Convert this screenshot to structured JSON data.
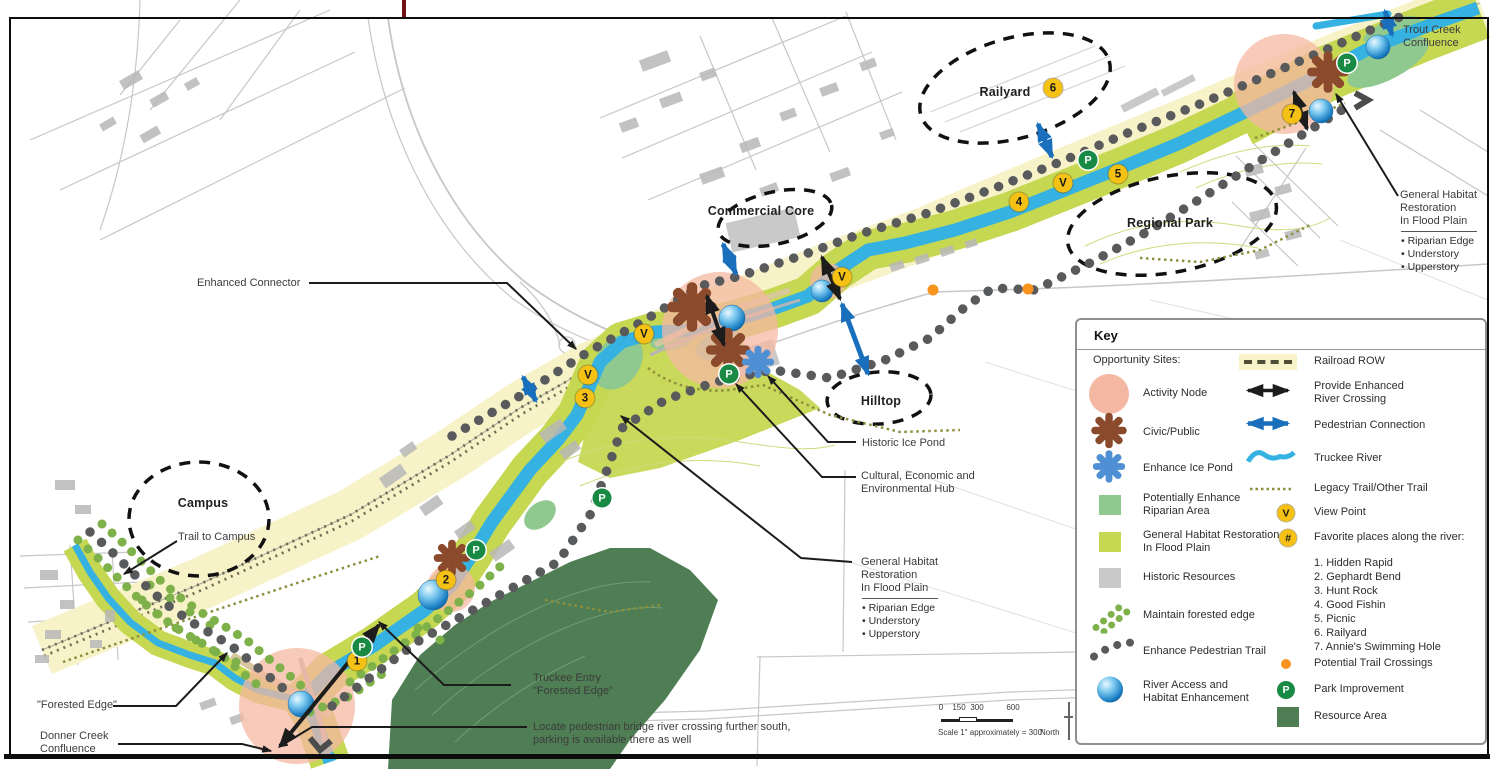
{
  "map": {
    "zone_labels": {
      "railyard": "Railyard",
      "commercial_core": "Commercial Core",
      "regional_park": "Regional Park",
      "hilltop": "Hilltop",
      "campus": "Campus"
    },
    "callouts": {
      "enhanced_connector": "Enhanced  Connector",
      "trail_to_campus": "Trail to Campus",
      "forested_edge": "\"Forested Edge\"",
      "donner_creek": "Donner Creek\nConfluence",
      "truckee_entry": "Truckee Entry\n\"Forested Edge\"",
      "pedestrian_bridge": "Locate pedestrian bridge river crossing further south,\nparking is available there as well",
      "historic_ice_pond": "Historic Ice Pond",
      "cultural_hub": "Cultural, Economic and\nEnvironmental Hub",
      "habitat_center": "General Habitat\nRestoration\nIn Flood Plain",
      "habitat_center_bullets": "• Riparian Edge\n• Understory\n• Upperstory",
      "trout_creek": "Trout Creek\nConfluence",
      "habitat_right": "General Habitat\nRestoration\nIn Flood Plain",
      "habitat_right_bullets": "• Riparian Edge\n• Understory\n• Upperstory"
    },
    "markers": {
      "viewpoint": "V",
      "park": "P",
      "numbers": [
        "1",
        "2",
        "3",
        "4",
        "5",
        "6",
        "7"
      ]
    }
  },
  "scalebar": {
    "ticks": [
      "0",
      "150",
      "300",
      "600"
    ],
    "caption": "Scale 1\" approximately = 300'",
    "north_label": "North"
  },
  "key": {
    "title": "Key",
    "opportunity_header": "Opportunity Sites:",
    "left_items": [
      {
        "label": "Activity Node"
      },
      {
        "label": "Civic/Public"
      },
      {
        "label": "Enhance Ice Pond"
      },
      {
        "label": "Potentially Enhance\nRiparian Area"
      },
      {
        "label": "General Habitat Restoration\nIn Flood Plain"
      },
      {
        "label": "Historic Resources"
      },
      {
        "label": "Maintain forested edge"
      },
      {
        "label": "Enhance Pedestrian Trail"
      },
      {
        "label": "River Access and\nHabitat Enhancement"
      }
    ],
    "right_items": [
      {
        "label": "Railroad ROW"
      },
      {
        "label": "Provide Enhanced\nRiver Crossing"
      },
      {
        "label": "Pedestrian Connection"
      },
      {
        "label": "Truckee River"
      },
      {
        "label": "Legacy Trail/Other Trail"
      },
      {
        "label": "View Point"
      },
      {
        "label": "Favorite places along the river:"
      },
      {
        "label": "Potential Trail Crossings"
      },
      {
        "label": "Park Improvement"
      },
      {
        "label": "Resource Area"
      }
    ],
    "favorites": [
      "1. Hidden Rapid",
      "2. Gephardt Bend",
      "3. Hunt Rock",
      "4. Good Fishin",
      "5. Picnic",
      "6. Railyard",
      "7. Annie's Swimming Hole"
    ],
    "viewpoint_glyph": "V",
    "favorites_glyph": "#",
    "park_glyph": "P"
  },
  "colors": {
    "row": "#f7f2c8",
    "habitat": "#c6d752",
    "riparian": "#8fc98f",
    "resource": "#4f7d54",
    "river": "#35b2e2",
    "activity": "#f4b8a2",
    "civic": "#8a4a2b",
    "icepond": "#4f8fd4",
    "viewpoint": "#f6c115",
    "park": "#188a44",
    "crossing": "#f8941e",
    "traildot": "#595a5c",
    "legacy": "#8e8f3d",
    "pedestrian": "#1a6fbd",
    "historic": "#c9c9c9",
    "tickred": "#701317"
  }
}
